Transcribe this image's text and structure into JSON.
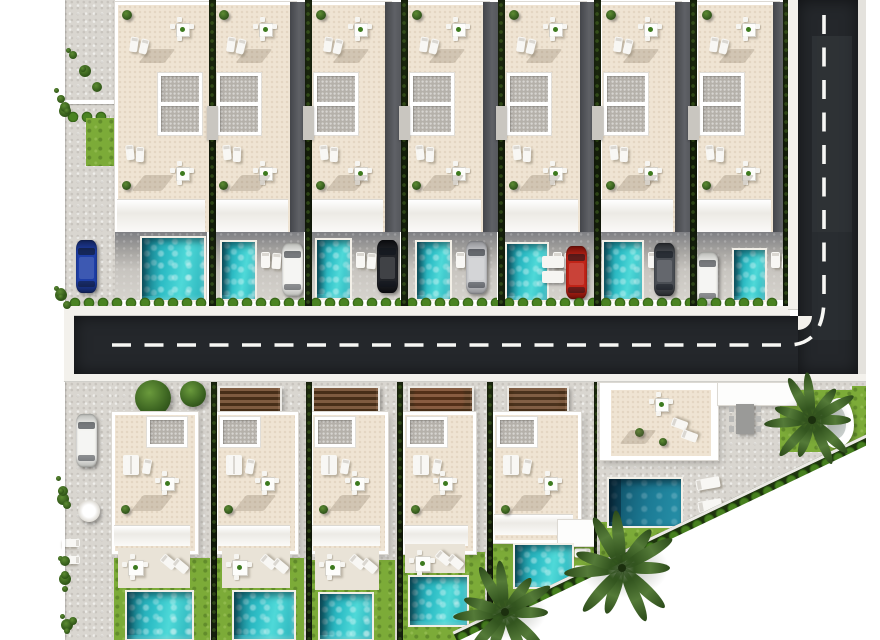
{
  "meta": {
    "type": "aerial-3d-site-plan-render",
    "description": "Top-down 3D architectural render of a residential villa development: a top row of seven white villas with private turquoise pools and parked cars, an L-shaped dark asphalt road with white dashed markings, a bottom row of five villas with carport pergolas and garden pools, and a larger corner villa plot with palm trees bounded by a diagonal site edge."
  },
  "palette": {
    "background": "#ffffff",
    "asphalt": "#24272b",
    "road_marking": "#f7f7f4",
    "sidewalk": "#f3f1ec",
    "paving": "#d9d6d0",
    "terrace": "#efe4d3",
    "building_white": "#ffffff",
    "skylight_grey": "#b5b1aa",
    "pool_teal": "#2fbfc7",
    "pool_deep": "#1c6f8e",
    "grass": "#7cab38",
    "hedge_dark": "#1a260e",
    "bush_green": "#47801f",
    "pergola_wood": "#7d5c3e",
    "palm_green": "#33551f"
  },
  "roads": {
    "h_road": [
      74,
      316,
      784,
      58
    ],
    "v_road": [
      798,
      0,
      60,
      374
    ],
    "sidewalk_top": [
      64,
      306,
      726,
      10
    ],
    "sidewalk_bottom": [
      64,
      374,
      802,
      8
    ],
    "sidewalk_vertical": [
      788,
      0,
      10,
      310
    ],
    "left_curb": [
      64,
      308,
      10,
      74
    ],
    "right_shoulder": [
      858,
      0,
      8,
      382
    ],
    "corner_curb": [
      798,
      316,
      14,
      14
    ],
    "dash_path": "M 112 345 H 788 Q 824 345 824 298 V 6",
    "shade_patches": [
      [
        812,
        36,
        40,
        196,
        0.07
      ],
      [
        812,
        232,
        40,
        108,
        0.04
      ]
    ]
  },
  "top_row": {
    "y": 0,
    "height": 306,
    "yard_y": 232,
    "yard_h": 68,
    "hedge_y": 296,
    "separators": [
      209,
      305,
      401,
      498,
      594,
      690
    ],
    "edge_hedge": [
      783,
      0,
      7,
      306
    ],
    "villas": [
      {
        "x": 62,
        "w": 148,
        "building": [
          115,
          92
        ],
        "skylight": "right",
        "pool": [
          140,
          236,
          62,
          62
        ],
        "car": {
          "color": "blue",
          "x": 76,
          "y": 240
        },
        "hedge": [
          68,
          140
        ],
        "side_yard": {
          "rect": [
            64,
            0,
            51,
            306
          ],
          "wall_y": 100,
          "bushes": [
            66,
            48,
            44,
            56
          ],
          "bush_row": [
            66,
            110,
            44
          ],
          "grass": [
            86,
            118,
            28,
            48
          ]
        }
      },
      {
        "x": 210,
        "w": 97,
        "building": [
          212,
          78
        ],
        "skylight": "left",
        "pool": [
          220,
          240,
          33,
          57
        ],
        "car": {
          "color": "white",
          "x": 282,
          "y": 243
        },
        "hedge": [
          212,
          93
        ]
      },
      {
        "x": 307,
        "w": 96,
        "building": [
          309,
          76
        ],
        "skylight": "left",
        "pool": [
          315,
          238,
          33,
          58
        ],
        "car": {
          "color": "black",
          "x": 377,
          "y": 240
        },
        "hedge": [
          309,
          92
        ]
      },
      {
        "x": 403,
        "w": 97,
        "building": [
          405,
          78
        ],
        "skylight": "left",
        "pool": [
          415,
          240,
          33,
          57
        ],
        "car": {
          "color": "silver",
          "x": 466,
          "y": 241
        },
        "hedge": [
          405,
          93
        ]
      },
      {
        "x": 500,
        "w": 97,
        "building": [
          502,
          78
        ],
        "skylight": "left",
        "pool": [
          505,
          242,
          40,
          56
        ],
        "car": {
          "color": "red",
          "x": 566,
          "y": 246
        },
        "hedge": [
          502,
          93
        ],
        "deck_boxes": [
          [
            542,
            256
          ],
          [
            542,
            271
          ]
        ]
      },
      {
        "x": 597,
        "w": 96,
        "building": [
          599,
          76
        ],
        "skylight": "left",
        "pool": [
          602,
          240,
          38,
          57
        ],
        "car": {
          "color": "grey",
          "x": 654,
          "y": 243
        },
        "hedge": [
          599,
          92
        ]
      },
      {
        "x": 693,
        "w": 97,
        "building": [
          695,
          78
        ],
        "skylight": "left",
        "pool": [
          732,
          248,
          31,
          50
        ],
        "car": {
          "color": "white",
          "x": 697,
          "y": 252
        },
        "hedge": [
          695,
          85
        ]
      }
    ]
  },
  "bottom_row": {
    "y": 382,
    "height": 258,
    "separators": [
      [
        211,
        382,
        258
      ],
      [
        306,
        382,
        258
      ],
      [
        397,
        382,
        258
      ],
      [
        487,
        382,
        258
      ],
      [
        594,
        382,
        192
      ]
    ],
    "villas": [
      {
        "x": 62,
        "w": 149,
        "building": [
          112,
          80,
          136
        ],
        "skylight": "right",
        "trees": [
          [
            135,
            398,
            36
          ],
          [
            180,
            394,
            26
          ]
        ],
        "side_yard": {
          "rect": [
            64,
            382,
            48,
            258
          ],
          "car": {
            "color": "white",
            "x": 76,
            "y": 414
          },
          "parasol": [
            78,
            500,
            22
          ],
          "loungers": [
            [
              68,
              535
            ],
            [
              68,
              552
            ]
          ]
        },
        "pool": [
          125,
          590,
          65,
          47
        ],
        "patio": [
          118,
          548,
          72,
          40
        ],
        "grass": [
          114,
          558,
          96,
          82
        ]
      },
      {
        "x": 213,
        "w": 93,
        "building": [
          215,
          77,
          136
        ],
        "skylight": "left",
        "pergola": {
          "x": 218,
          "w": 60,
          "car": null
        },
        "pool": [
          232,
          590,
          60,
          47
        ],
        "patio": [
          222,
          548,
          68,
          40
        ],
        "grass": [
          215,
          558,
          89,
          82
        ]
      },
      {
        "x": 308,
        "w": 89,
        "building": [
          310,
          72,
          136
        ],
        "skylight": "left",
        "pergola": {
          "x": 312,
          "w": 64,
          "car": null
        },
        "pool": [
          318,
          592,
          52,
          45
        ],
        "patio": [
          315,
          548,
          64,
          42
        ],
        "grass": [
          310,
          560,
          85,
          80
        ]
      },
      {
        "x": 399,
        "w": 88,
        "building": [
          402,
          68,
          136
        ],
        "skylight": "left",
        "pergola": {
          "x": 408,
          "w": 62,
          "car": "red"
        },
        "pool": [
          408,
          575,
          57,
          48
        ],
        "patio": [
          405,
          544,
          60,
          29
        ],
        "grass": [
          402,
          552,
          83,
          88
        ]
      },
      {
        "x": 489,
        "w": 105,
        "building": [
          492,
          83,
          125
        ],
        "skylight": "left",
        "pergola": {
          "x": 507,
          "w": 58,
          "car": "grey"
        },
        "pool": [
          513,
          543,
          57,
          42
        ],
        "loungers": [
          [
            578,
            545
          ],
          [
            578,
            562
          ]
        ],
        "grass": [
          492,
          528,
          102,
          112
        ],
        "white_box": [
          558,
          520,
          38,
          26
        ]
      }
    ]
  },
  "corner_plot": {
    "container": [
      597,
      382,
      269,
      258
    ],
    "paving_clip": "polygon(0px 0px, 269px 0px, 269px 70px, 5px 196px, 0px 196px)",
    "grass_top": [
      3,
      0,
      188,
      7
    ],
    "grass_right": [
      255,
      4,
      14,
      62
    ],
    "palm_patch": [
      183,
      8,
      72,
      62
    ],
    "grass_bl": [
      3,
      140,
      92,
      56
    ],
    "building": [
      3,
      1,
      118,
      77
    ],
    "terrace": [
      14,
      6,
      100,
      66
    ],
    "wing": [
      121,
      1,
      78,
      22
    ],
    "grey_dining": [
      139,
      22,
      18,
      30
    ],
    "pool": [
      10,
      95,
      72,
      47
    ],
    "sunbeds": [
      [
        99,
        96
      ],
      [
        101,
        118
      ]
    ],
    "kidney_spa": [
      223,
      16,
      34,
      50
    ],
    "hedge_diagonal": {
      "x": 456,
      "y": 631,
      "len": 462,
      "rot": -25.5,
      "th": 13
    }
  },
  "site_mask": {
    "triangle": [
      [
        460,
        640
      ],
      [
        880,
        439
      ],
      [
        880,
        640
      ]
    ],
    "right_margin": [
      866,
      0,
      14,
      452
    ]
  },
  "palms": [
    [
      505,
      612,
      100
    ],
    [
      622,
      568,
      112
    ],
    [
      812,
      420,
      92
    ]
  ],
  "margin_shrubs": [
    [
      54,
      88,
      20,
      30
    ],
    [
      54,
      286,
      18,
      26
    ],
    [
      56,
      476,
      16,
      34
    ],
    [
      58,
      556,
      14,
      44
    ],
    [
      60,
      614,
      18,
      24
    ]
  ],
  "cars_palette": {
    "blue": [
      "#1e3ea6",
      "#122257"
    ],
    "white": [
      "#f4f4f1",
      "#b9bab6"
    ],
    "black": [
      "#212328",
      "#0b0c0f"
    ],
    "silver": [
      "#cdced1",
      "#8f9094"
    ],
    "red": [
      "#c02418",
      "#6e0f08"
    ],
    "grey": [
      "#4b4f55",
      "#26282c"
    ]
  }
}
